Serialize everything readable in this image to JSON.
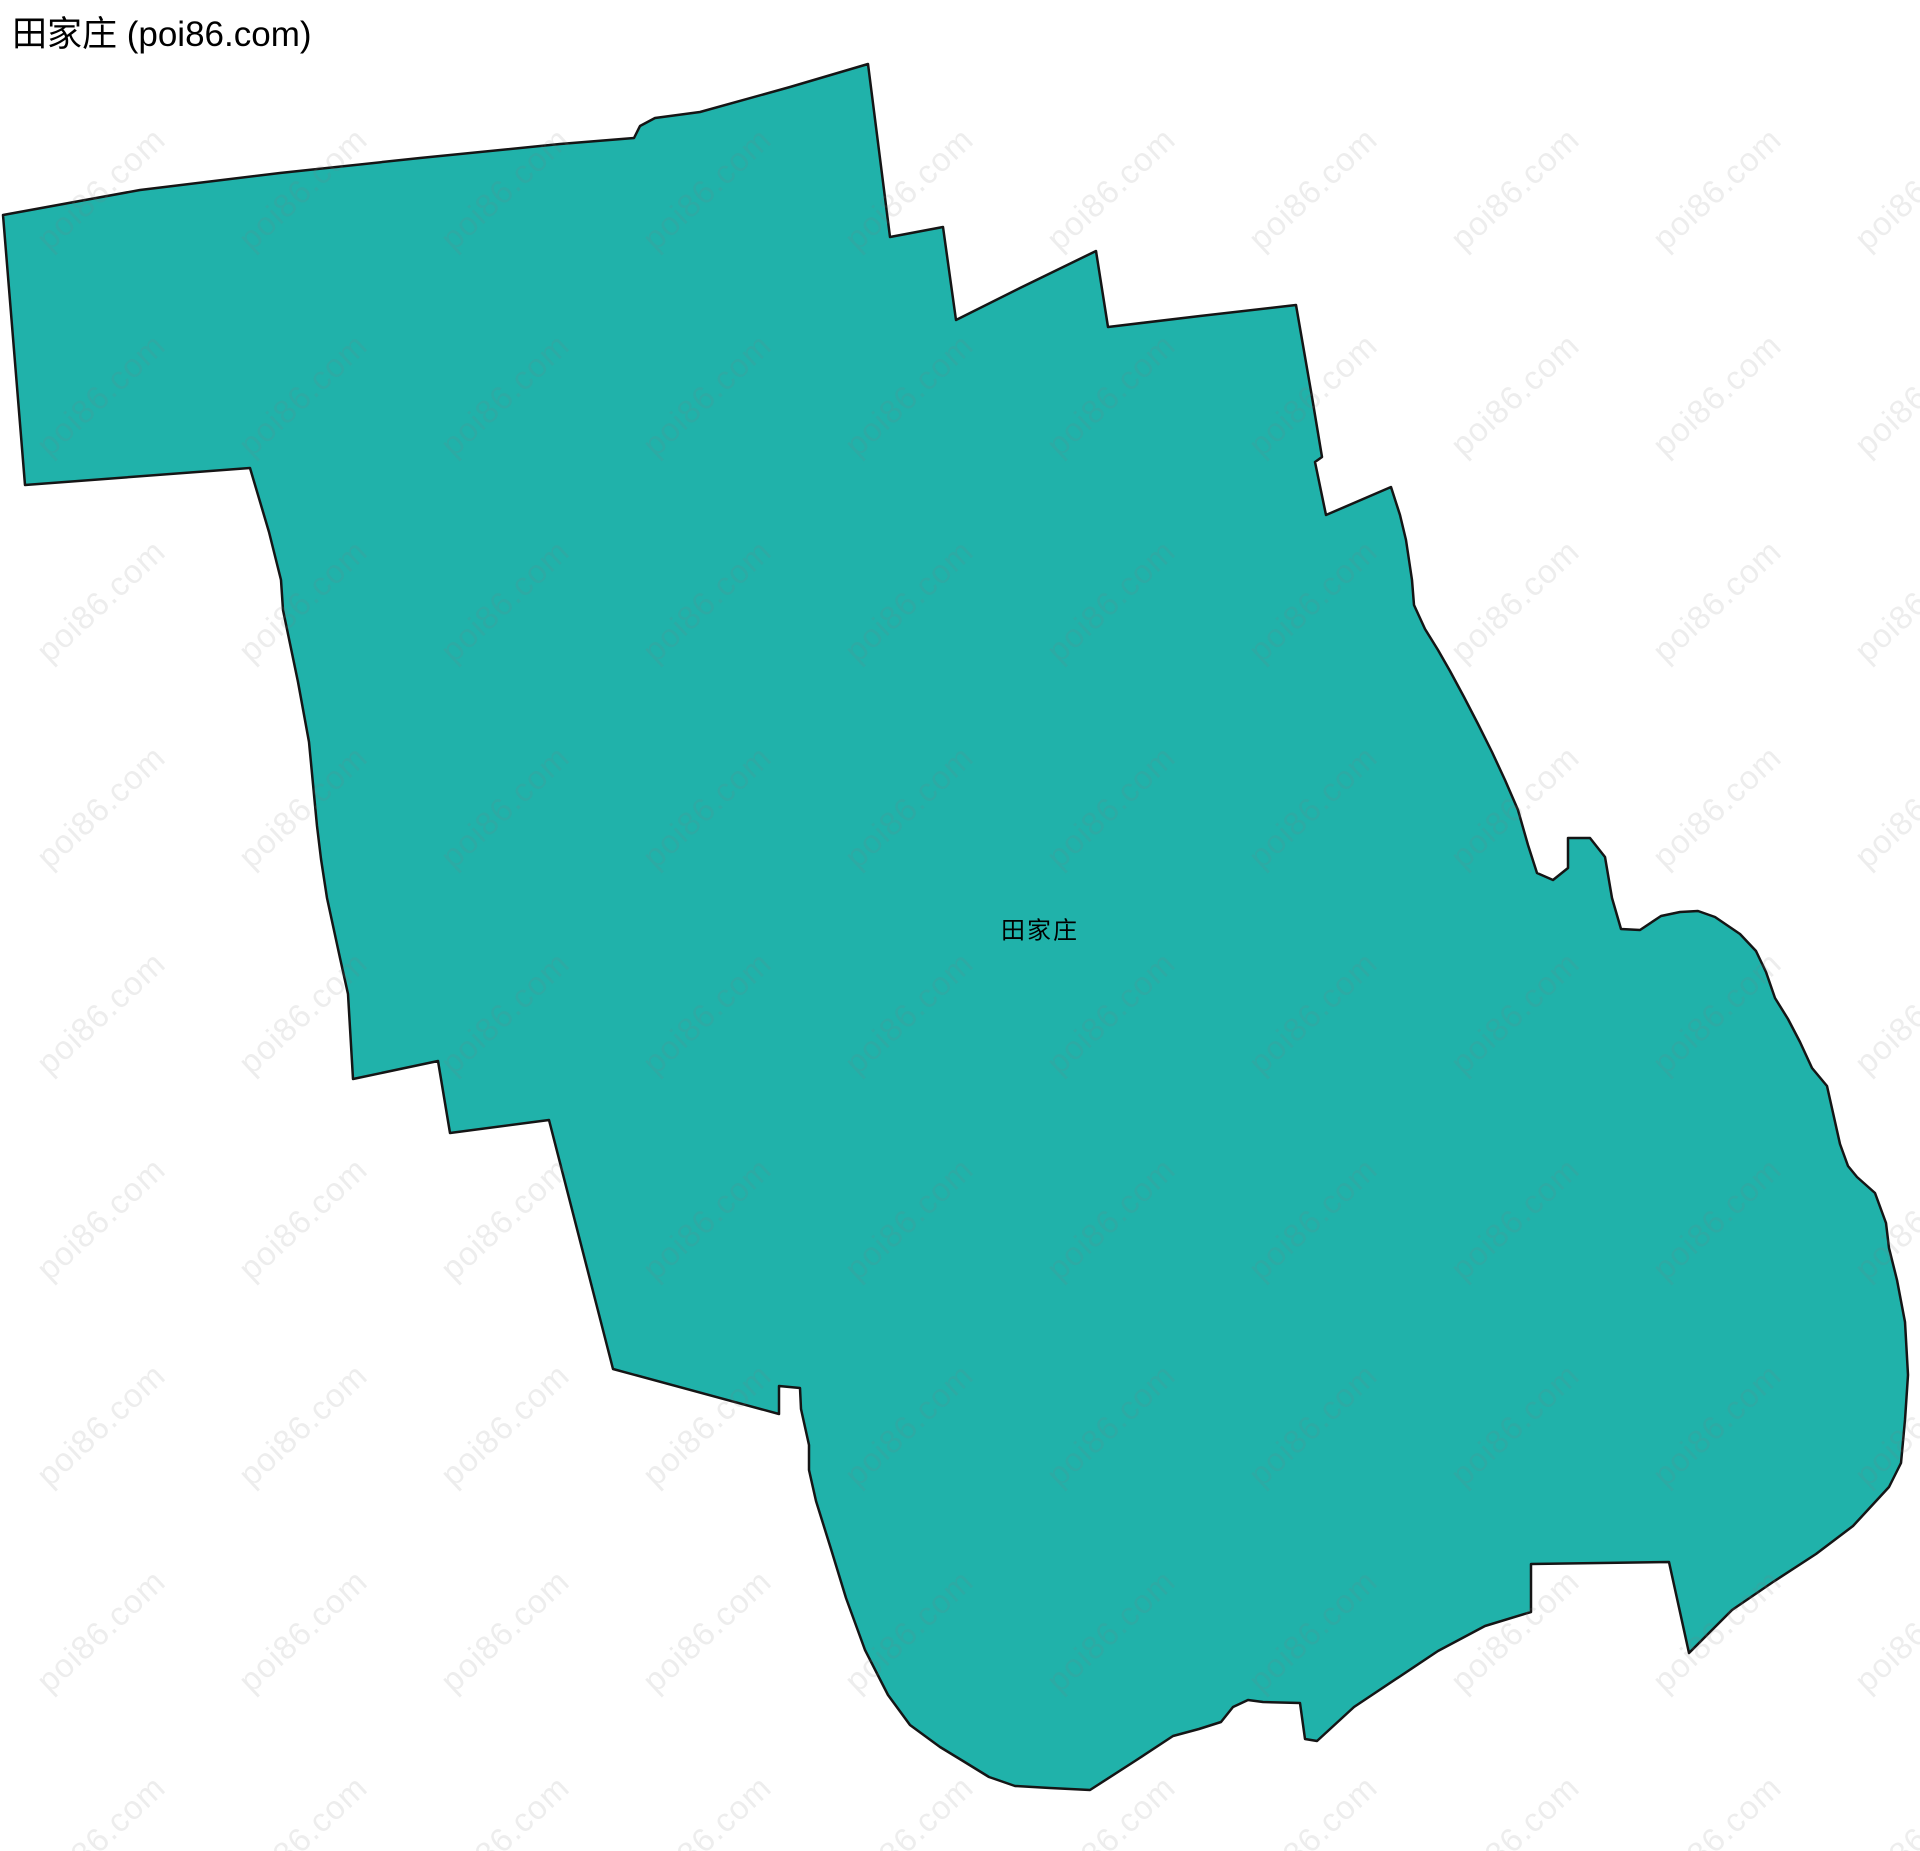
{
  "page": {
    "title": "田家庄 (poi86.com)",
    "background_color": "#ffffff"
  },
  "map": {
    "region_label": "田家庄",
    "label_position": {
      "x": 1040,
      "y": 928
    },
    "fill_color": "#20b2aa",
    "stroke_color": "#151515",
    "stroke_width": 2.5,
    "outline_points": [
      [
        3,
        215
      ],
      [
        140,
        190
      ],
      [
        280,
        173
      ],
      [
        420,
        158
      ],
      [
        560,
        144
      ],
      [
        634,
        138
      ],
      [
        640,
        126
      ],
      [
        655,
        118
      ],
      [
        700,
        112
      ],
      [
        790,
        87
      ],
      [
        868,
        64
      ],
      [
        890,
        237
      ],
      [
        943,
        227
      ],
      [
        956,
        320
      ],
      [
        1020,
        288
      ],
      [
        1096,
        251
      ],
      [
        1108,
        327
      ],
      [
        1200,
        316
      ],
      [
        1296,
        305
      ],
      [
        1312,
        397
      ],
      [
        1322,
        457
      ],
      [
        1315,
        462
      ],
      [
        1326,
        515
      ],
      [
        1391,
        487
      ],
      [
        1400,
        515
      ],
      [
        1406,
        540
      ],
      [
        1412,
        580
      ],
      [
        1414,
        605
      ],
      [
        1425,
        629
      ],
      [
        1438,
        650
      ],
      [
        1450,
        671
      ],
      [
        1464,
        697
      ],
      [
        1478,
        724
      ],
      [
        1492,
        752
      ],
      [
        1505,
        780
      ],
      [
        1518,
        810
      ],
      [
        1528,
        845
      ],
      [
        1537,
        873
      ],
      [
        1553,
        880
      ],
      [
        1568,
        868
      ],
      [
        1568,
        838
      ],
      [
        1590,
        838
      ],
      [
        1605,
        857
      ],
      [
        1612,
        898
      ],
      [
        1621,
        929
      ],
      [
        1640,
        930
      ],
      [
        1661,
        916
      ],
      [
        1680,
        912
      ],
      [
        1698,
        911
      ],
      [
        1715,
        917
      ],
      [
        1740,
        934
      ],
      [
        1756,
        951
      ],
      [
        1766,
        972
      ],
      [
        1775,
        998
      ],
      [
        1788,
        1019
      ],
      [
        1800,
        1042
      ],
      [
        1812,
        1068
      ],
      [
        1827,
        1086
      ],
      [
        1840,
        1144
      ],
      [
        1848,
        1166
      ],
      [
        1857,
        1177
      ],
      [
        1875,
        1193
      ],
      [
        1886,
        1223
      ],
      [
        1889,
        1248
      ],
      [
        1897,
        1280
      ],
      [
        1905,
        1322
      ],
      [
        1908,
        1375
      ],
      [
        1905,
        1420
      ],
      [
        1901,
        1463
      ],
      [
        1889,
        1487
      ],
      [
        1853,
        1526
      ],
      [
        1816,
        1554
      ],
      [
        1773,
        1582
      ],
      [
        1732,
        1610
      ],
      [
        1689,
        1653
      ],
      [
        1669,
        1562
      ],
      [
        1531,
        1564
      ],
      [
        1531,
        1612
      ],
      [
        1485,
        1626
      ],
      [
        1438,
        1651
      ],
      [
        1354,
        1707
      ],
      [
        1317,
        1741
      ],
      [
        1305,
        1739
      ],
      [
        1300,
        1703
      ],
      [
        1263,
        1702
      ],
      [
        1248,
        1700
      ],
      [
        1233,
        1707
      ],
      [
        1221,
        1722
      ],
      [
        1199,
        1729
      ],
      [
        1173,
        1736
      ],
      [
        1135,
        1761
      ],
      [
        1090,
        1790
      ],
      [
        1050,
        1788
      ],
      [
        1015,
        1786
      ],
      [
        989,
        1777
      ],
      [
        963,
        1761
      ],
      [
        940,
        1747
      ],
      [
        910,
        1725
      ],
      [
        888,
        1695
      ],
      [
        865,
        1650
      ],
      [
        846,
        1598
      ],
      [
        831,
        1549
      ],
      [
        816,
        1501
      ],
      [
        809,
        1470
      ],
      [
        809,
        1445
      ],
      [
        801,
        1409
      ],
      [
        800,
        1388
      ],
      [
        779,
        1386
      ],
      [
        779,
        1414
      ],
      [
        613,
        1369
      ],
      [
        549,
        1120
      ],
      [
        450,
        1133
      ],
      [
        438,
        1061
      ],
      [
        353,
        1079
      ],
      [
        348,
        994
      ],
      [
        340,
        958
      ],
      [
        327,
        898
      ],
      [
        321,
        859
      ],
      [
        317,
        826
      ],
      [
        309,
        742
      ],
      [
        298,
        682
      ],
      [
        283,
        610
      ],
      [
        281,
        580
      ],
      [
        269,
        532
      ],
      [
        250,
        468
      ],
      [
        25,
        485
      ]
    ]
  },
  "watermark": {
    "text": "poi86.com",
    "color": "rgba(125,125,125,0.14)",
    "rotation_deg": -43,
    "grid": {
      "start_x": 101,
      "start_y": 189,
      "step_x": 202,
      "step_y": 206,
      "cols": 10,
      "rows": 9
    }
  }
}
